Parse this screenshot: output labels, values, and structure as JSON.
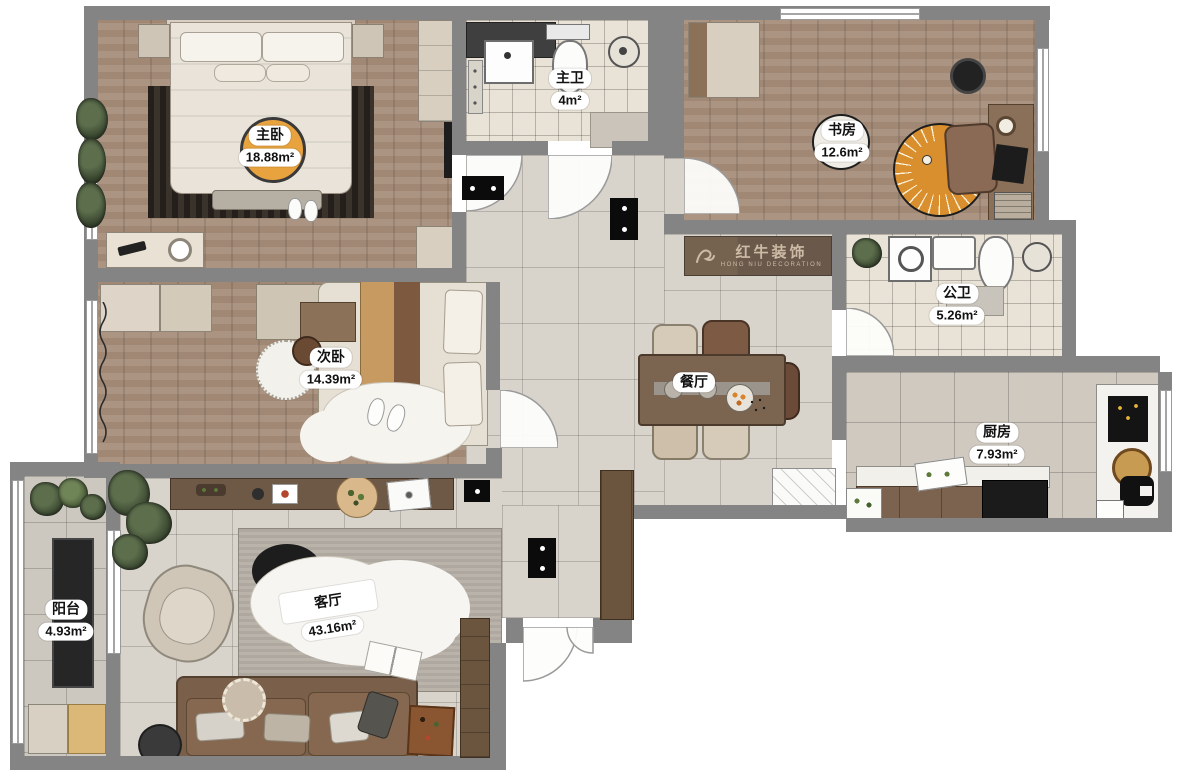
{
  "plan": {
    "title": "apartment floor plan",
    "brand": {
      "name": "红牛装饰",
      "subtitle": "HONG NIU DECORATION"
    },
    "rooms": [
      {
        "id": "master-bedroom",
        "name": "主卧",
        "area": "18.88m²"
      },
      {
        "id": "master-bathroom",
        "name": "主卫",
        "area": "4m²"
      },
      {
        "id": "study",
        "name": "书房",
        "area": "12.6m²"
      },
      {
        "id": "public-bathroom",
        "name": "公卫",
        "area": "5.26m²"
      },
      {
        "id": "second-bedroom",
        "name": "次卧",
        "area": "14.39m²"
      },
      {
        "id": "dining-room",
        "name": "餐厅",
        "area": ""
      },
      {
        "id": "kitchen",
        "name": "厨房",
        "area": "7.93m²"
      },
      {
        "id": "living-room",
        "name": "客厅",
        "area": "43.16m²"
      },
      {
        "id": "balcony",
        "name": "阳台",
        "area": "4.93m²"
      }
    ],
    "colors": {
      "wall": "#848484",
      "wood_floor": "#a78e7a",
      "tile_floor": "#d8d3cb",
      "bath_tile": "#e9e2d6",
      "accent_orange": "#e8a33f",
      "rug_gray": "#b5afa6",
      "sofa_brown": "#7a5f4b",
      "logo_brown": "#6a594b",
      "logo_text": "#cdbba6"
    }
  }
}
